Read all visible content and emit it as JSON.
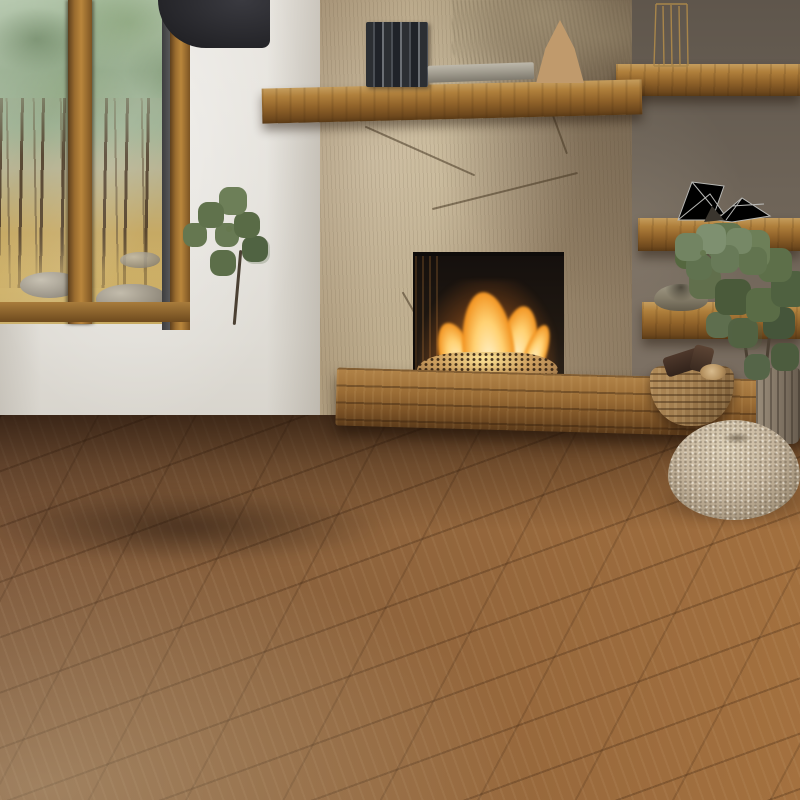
{
  "scene": {
    "description": "Photorealistic living-room lifestyle photo showcasing a round light-gray basketweave rug",
    "objects": {
      "rug": "round gray rug with raised checkered basketweave pattern",
      "sofa": "greige fabric sofa with plump cushions and right armrest",
      "fireplace": "carved natural stone chimney with burning gas fire over pebble bed",
      "mantel": "rustic wooden mantel shelf with books, flat book, terracotta cone vase and dried botanicals",
      "window": "floor-to-ceiling window with pine forest view",
      "shelves": "three rustic wooden wall shelves with brass wire object, silver wire sculpture and stone bowl",
      "plants": "potted green plant behind sofa and large leafy plant in driftwood planter",
      "basket": "woven rattan basket holding firewood logs",
      "pouf": "round knitted beige pouf",
      "floor": "warm oak plank floor",
      "ceiling_object": "dark curved pendant volume at ceiling"
    }
  },
  "rug_spec": {
    "shape": "round",
    "color": "light gray",
    "pattern": "offset checkerboard basketweave with dark seam shadows"
  },
  "palette": {
    "wallWhite": "#e8e5df",
    "wallRight": "#5f564c",
    "stoneLight": "#c2b190",
    "stoneMid": "#b3a084",
    "stoneDark": "#a08c6f",
    "woodMid": "#b0803c",
    "frameWood": "#9a6c2f",
    "floorCool": "#7c573a",
    "floorWarm": "#a4713f",
    "sofaHi": "#c9bfb1",
    "sofaMid": "#988d80",
    "sofaDark": "#655b4f",
    "rugBase": "#c8c8c6",
    "fireCore": "#fff4cf",
    "fireMid": "#ffd172",
    "fireDeep": "#f2921f",
    "ember": "#bb905c",
    "leaf": "#66784f",
    "pouf": "#c2b29a",
    "basket": "#a07c4e",
    "terracotta": "#c09a6c",
    "bowl": "#867e6a",
    "planter": "#837666",
    "ceilingObj": "#3a3a40",
    "forestCanopy": "#9db394",
    "wireSilver": "#b8b8b5",
    "wireBrass": "#a8854a"
  }
}
